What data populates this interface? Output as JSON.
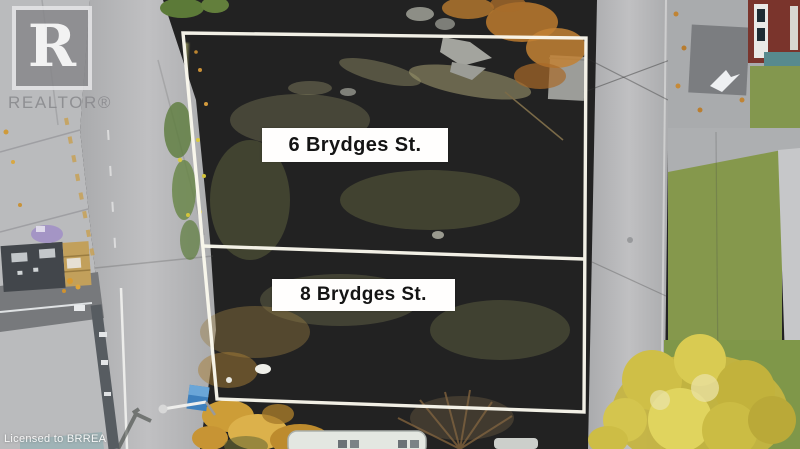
{
  "watermark": {
    "logo_letter": "R",
    "brand": "REALTOR®"
  },
  "parcels": [
    {
      "label": "6 Brydges St."
    },
    {
      "label": "8 Brydges St."
    }
  ],
  "footer": {
    "license_text": "Licensed to BRREA"
  },
  "colors": {
    "boundary_line": "#fbf9ee",
    "label_background": "#fffefd",
    "label_text": "#141414",
    "lot_grass": "#9b9b61",
    "outer_grass": "#7f8e4b",
    "road": "#b3b3b5"
  }
}
